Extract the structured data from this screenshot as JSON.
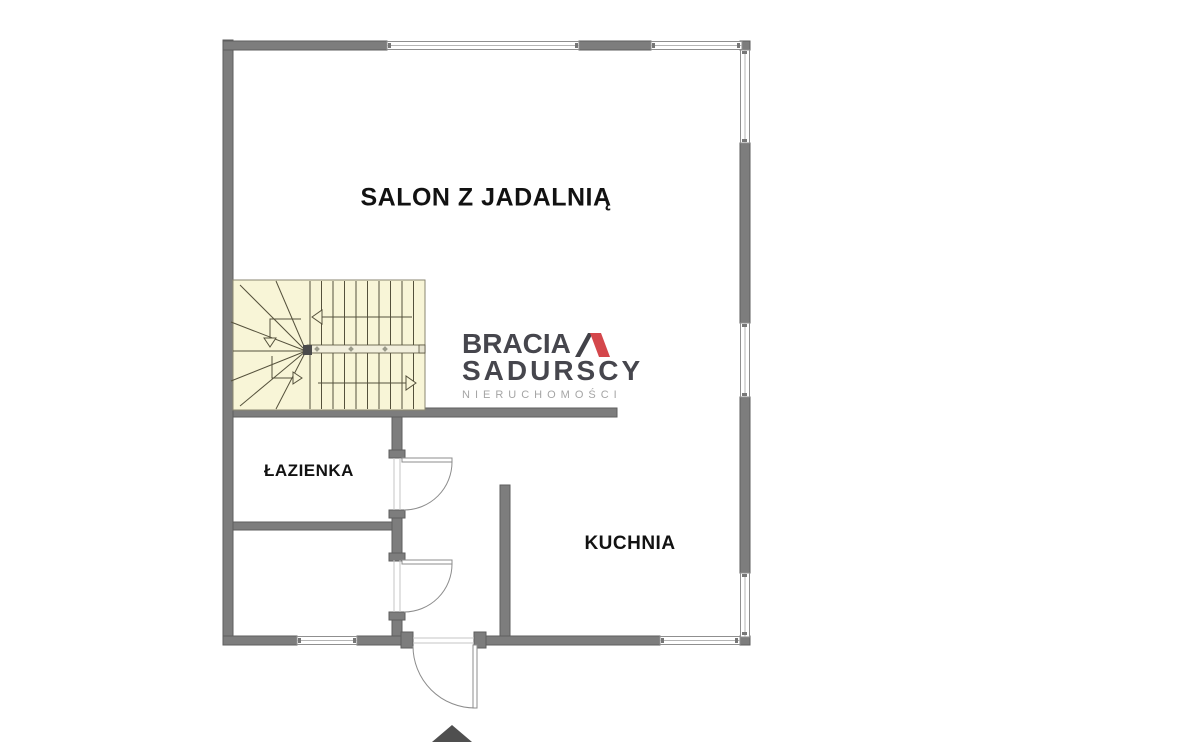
{
  "plan": {
    "type": "floor-plan",
    "background": "#ffffff",
    "wall_color": "#7d7d7d",
    "wall_edge_color": "#5e5e5e",
    "window_frame_color": "#8f8f8f",
    "door_color": "#8c8c8c",
    "stair_fill": "#f8f5d7",
    "stair_line_color": "#55513c",
    "entrance_arrow_color": "#4f4f4f"
  },
  "rooms": {
    "salon": {
      "label": "SALON Z JADALNIĄ"
    },
    "lazienka": {
      "label": "ŁAZIENKA"
    },
    "kuchnia": {
      "label": "KUCHNIA"
    }
  },
  "logo": {
    "line1": "BRACIA",
    "line2": "SADURSCY",
    "line3": "NIERUCHOMOŚCI",
    "mark_black": "#2e2e35",
    "mark_red": "#d03438",
    "text_color": "#32323a",
    "subtext_color": "#9b9b9b"
  }
}
